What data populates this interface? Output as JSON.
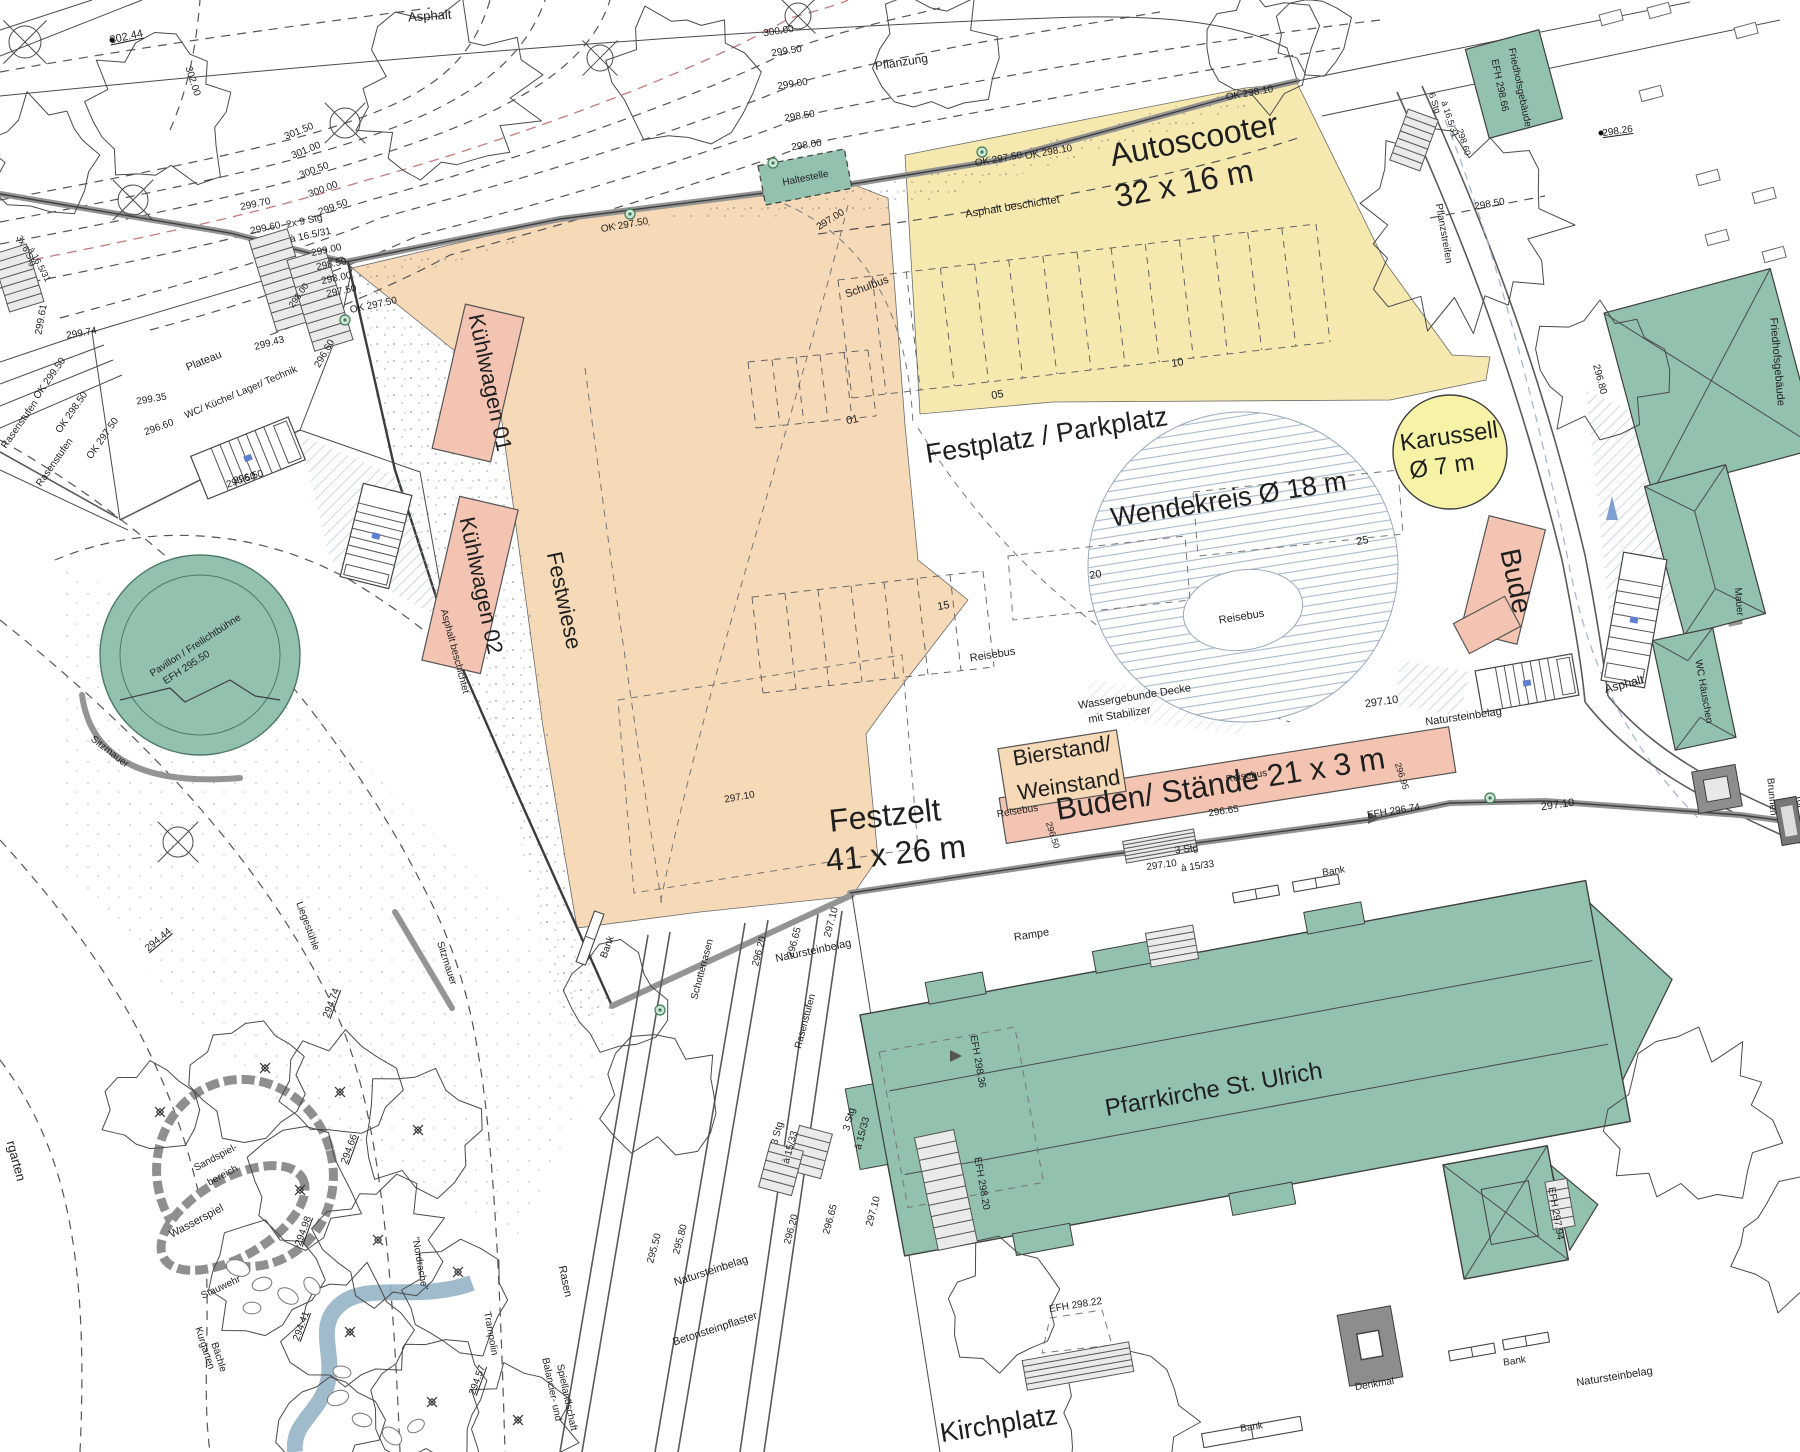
{
  "plan": {
    "colors": {
      "text": "#1f1f1f",
      "red": "#b85c5c",
      "orange": "#f6d9b6",
      "yellow": "#f6e9b0",
      "pink": "#f4c4b2",
      "green": "#92c1ad",
      "green_edge": "#3d6a58",
      "pale_yellow": "#f6f3a6",
      "water_blue": "#8fafc2",
      "hatch_blue": "#a9bdd8",
      "wall_gray": "#949494",
      "monument_gray": "#8d8d8d",
      "line_dark": "#3c3c3c"
    },
    "labels": [
      {
        "t": "302.44",
        "x": 127,
        "y": 40,
        "r": -12,
        "u": 1
      },
      {
        "t": "Asphalt",
        "x": 430,
        "y": 20,
        "r": -4,
        "s": 13
      },
      {
        "t": "302.00",
        "x": 190,
        "y": 82,
        "r": 72,
        "s": 10
      },
      {
        "t": "301.50",
        "x": 300,
        "y": 134,
        "r": -22,
        "s": 10
      },
      {
        "t": "301.00",
        "x": 307,
        "y": 153,
        "r": -22,
        "s": 10
      },
      {
        "t": "300.50",
        "x": 315,
        "y": 173,
        "r": -20,
        "s": 10
      },
      {
        "t": "300.00",
        "x": 324,
        "y": 192,
        "r": -20,
        "s": 10,
        "c": "red"
      },
      {
        "t": "299.50",
        "x": 334,
        "y": 210,
        "r": -20,
        "s": 10
      },
      {
        "t": "299.70",
        "x": 256,
        "y": 207,
        "r": -12,
        "s": 10
      },
      {
        "t": "299.60",
        "x": 266,
        "y": 231,
        "r": -12,
        "s": 10
      },
      {
        "t": "2x 9 Stg",
        "x": 305,
        "y": 224,
        "r": -12,
        "s": 10
      },
      {
        "t": "à 16.5/31",
        "x": 311,
        "y": 238,
        "r": -12,
        "s": 10
      },
      {
        "t": "299.00",
        "x": 327,
        "y": 253,
        "r": -12,
        "s": 10
      },
      {
        "t": "298.50",
        "x": 332,
        "y": 267,
        "r": -12,
        "s": 10
      },
      {
        "t": "298.00",
        "x": 337,
        "y": 281,
        "r": -12,
        "s": 10
      },
      {
        "t": "297.50",
        "x": 342,
        "y": 294,
        "r": -12,
        "s": 10
      },
      {
        "t": "OK 297.50",
        "x": 374,
        "y": 308,
        "r": -12,
        "s": 10
      },
      {
        "t": "OK 297.50",
        "x": 625,
        "y": 228,
        "r": -10,
        "s": 10
      },
      {
        "t": "297.00",
        "x": 832,
        "y": 222,
        "r": -32,
        "s": 10
      },
      {
        "t": "300.00",
        "x": 779,
        "y": 34,
        "r": -9,
        "s": 10,
        "c": "red"
      },
      {
        "t": "299.50",
        "x": 787,
        "y": 54,
        "r": -9,
        "s": 10
      },
      {
        "t": "299.00",
        "x": 793,
        "y": 87,
        "r": -9,
        "s": 10
      },
      {
        "t": "298.50",
        "x": 800,
        "y": 119,
        "r": -9,
        "s": 10
      },
      {
        "t": "298.00",
        "x": 807,
        "y": 148,
        "r": -9,
        "s": 10
      },
      {
        "t": "Pflanzung",
        "x": 902,
        "y": 66,
        "r": -9,
        "s": 12
      },
      {
        "t": "Haltestelle",
        "x": 806,
        "y": 181,
        "r": -11,
        "s": 10
      },
      {
        "t": "OK 297.50",
        "x": 999,
        "y": 162,
        "r": -10,
        "s": 10
      },
      {
        "t": "OK 298.10",
        "x": 1049,
        "y": 155,
        "r": -10,
        "s": 10
      },
      {
        "t": "OK 298.10",
        "x": 1250,
        "y": 96,
        "r": -10,
        "s": 10
      },
      {
        "t": "Asphalt beschichtet",
        "x": 1013,
        "y": 210,
        "r": -9,
        "s": 11
      },
      {
        "t": "Schulbus",
        "x": 868,
        "y": 290,
        "r": -20,
        "s": 11
      },
      {
        "t": "Autoscooter",
        "x": 1196,
        "y": 150,
        "r": -11,
        "s": 32
      },
      {
        "t": "32 x 16 m",
        "x": 1186,
        "y": 194,
        "r": -11,
        "s": 32
      },
      {
        "t": "6 Stg",
        "x": 1432,
        "y": 104,
        "r": 72,
        "s": 9
      },
      {
        "t": "à 16.5/31",
        "x": 1447,
        "y": 120,
        "r": 72,
        "s": 9
      },
      {
        "t": "298.60",
        "x": 1461,
        "y": 143,
        "r": 72,
        "s": 9
      },
      {
        "t": "EFH 298.66",
        "x": 1497,
        "y": 86,
        "r": 78,
        "s": 10
      },
      {
        "t": "Friedhofsgebäude",
        "x": 1517,
        "y": 88,
        "r": 78,
        "s": 10
      },
      {
        "t": "298.26",
        "x": 1618,
        "y": 134,
        "r": -8,
        "s": 10,
        "u": 1
      },
      {
        "t": "298.50",
        "x": 1490,
        "y": 207,
        "r": -10,
        "s": 10
      },
      {
        "t": "Pflanzstreifen",
        "x": 1441,
        "y": 234,
        "r": 80,
        "s": 10
      },
      {
        "t": "Friedhofsgebäude",
        "x": 1774,
        "y": 362,
        "r": 85,
        "s": 11
      },
      {
        "t": "296.80",
        "x": 1597,
        "y": 380,
        "r": 75,
        "s": 10
      },
      {
        "t": "Karussell",
        "x": 1450,
        "y": 444,
        "r": -8,
        "s": 24
      },
      {
        "t": "Ø 7 m",
        "x": 1443,
        "y": 474,
        "r": -8,
        "s": 24
      },
      {
        "t": "Festplatz / Parkplatz",
        "x": 1048,
        "y": 444,
        "r": -9,
        "s": 27
      },
      {
        "t": "Wendekreis Ø 18 m",
        "x": 1230,
        "y": 508,
        "r": -9,
        "s": 27
      },
      {
        "t": "Reisebus",
        "x": 1242,
        "y": 620,
        "r": -9,
        "s": 11
      },
      {
        "t": "Reisebus",
        "x": 993,
        "y": 658,
        "r": -9,
        "s": 11
      },
      {
        "t": "Reisebus",
        "x": 1018,
        "y": 814,
        "r": -9,
        "s": 10
      },
      {
        "t": "Reisebus",
        "x": 1247,
        "y": 779,
        "r": -9,
        "s": 10
      },
      {
        "t": "01",
        "x": 853,
        "y": 423,
        "r": -12,
        "s": 11
      },
      {
        "t": "05",
        "x": 998,
        "y": 398,
        "r": -10,
        "s": 11
      },
      {
        "t": "10",
        "x": 1178,
        "y": 366,
        "r": -10,
        "s": 11
      },
      {
        "t": "15",
        "x": 944,
        "y": 609,
        "r": -10,
        "s": 11
      },
      {
        "t": "20",
        "x": 1096,
        "y": 578,
        "r": -10,
        "s": 11
      },
      {
        "t": "25",
        "x": 1363,
        "y": 544,
        "r": -10,
        "s": 11
      },
      {
        "t": "Wassergebunde Decke",
        "x": 1135,
        "y": 700,
        "r": -9,
        "s": 11
      },
      {
        "t": "mit Stabilizer",
        "x": 1120,
        "y": 718,
        "r": -9,
        "s": 11
      },
      {
        "t": "Bude",
        "x": 1507,
        "y": 583,
        "r": 78,
        "s": 28
      },
      {
        "t": "Bierstand/",
        "x": 1063,
        "y": 758,
        "r": -9,
        "s": 22
      },
      {
        "t": "Weinstand",
        "x": 1070,
        "y": 792,
        "r": -9,
        "s": 22
      },
      {
        "t": "Buden/ Stände 21 x 3 m",
        "x": 1222,
        "y": 794,
        "r": -9,
        "s": 31
      },
      {
        "t": "296.65",
        "x": 1224,
        "y": 814,
        "r": -9,
        "s": 10
      },
      {
        "t": "296.95",
        "x": 1399,
        "y": 777,
        "r": 72,
        "s": 9
      },
      {
        "t": "Festwiese",
        "x": 557,
        "y": 602,
        "r": 78,
        "s": 22
      },
      {
        "t": "Kühlwagen 01",
        "x": 483,
        "y": 384,
        "r": 78,
        "s": 22
      },
      {
        "t": "Kühlwagen 02",
        "x": 474,
        "y": 587,
        "r": 78,
        "s": 22
      },
      {
        "t": "Festzelt",
        "x": 886,
        "y": 826,
        "r": -6,
        "s": 32
      },
      {
        "t": "41 x 26 m",
        "x": 897,
        "y": 864,
        "r": -6,
        "s": 32
      },
      {
        "t": "296.50",
        "x": 1050,
        "y": 836,
        "r": 72,
        "s": 9
      },
      {
        "t": "Mauer",
        "x": 1736,
        "y": 602,
        "r": 85,
        "s": 10
      },
      {
        "t": "WC Häuschen",
        "x": 1701,
        "y": 692,
        "r": 80,
        "s": 10
      },
      {
        "t": "Asphalt",
        "x": 1625,
        "y": 688,
        "r": -15,
        "s": 12
      },
      {
        "t": "Brunnen",
        "x": 1769,
        "y": 797,
        "r": 85,
        "s": 10
      },
      {
        "t": "Tor",
        "x": 1797,
        "y": 802,
        "r": 80,
        "s": 10
      },
      {
        "t": "297.10",
        "x": 1558,
        "y": 808,
        "r": -8,
        "s": 11
      },
      {
        "t": "297.10",
        "x": 1382,
        "y": 705,
        "r": -8,
        "s": 11
      },
      {
        "t": "Natursteinbelag",
        "x": 1464,
        "y": 720,
        "r": -8,
        "s": 11
      },
      {
        "t": "297.10",
        "x": 1162,
        "y": 868,
        "r": -8,
        "s": 10
      },
      {
        "t": "3 Stg",
        "x": 1187,
        "y": 852,
        "r": -8,
        "s": 10
      },
      {
        "t": "à 15/33",
        "x": 1198,
        "y": 869,
        "r": -8,
        "s": 10
      },
      {
        "t": "Bank",
        "x": 1334,
        "y": 874,
        "r": -9,
        "s": 10
      },
      {
        "t": "Rampe",
        "x": 1032,
        "y": 938,
        "r": -9,
        "s": 11
      },
      {
        "t": "Natursteinbelag",
        "x": 814,
        "y": 954,
        "r": -12,
        "s": 11
      },
      {
        "t": "297.10",
        "x": 740,
        "y": 800,
        "r": -10,
        "s": 10
      },
      {
        "t": "297.10",
        "x": 834,
        "y": 923,
        "r": -75,
        "s": 10
      },
      {
        "t": "296.65",
        "x": 797,
        "y": 943,
        "r": -75,
        "s": 10
      },
      {
        "t": "296.20",
        "x": 762,
        "y": 952,
        "r": -75,
        "s": 10
      },
      {
        "t": "Rasenstufen",
        "x": 808,
        "y": 1022,
        "r": -75,
        "s": 10
      },
      {
        "t": "Schotterrasen",
        "x": 705,
        "y": 970,
        "r": -75,
        "s": 10
      },
      {
        "t": "Bank",
        "x": 610,
        "y": 948,
        "r": -70,
        "s": 10
      },
      {
        "t": "3 Stg",
        "x": 780,
        "y": 1134,
        "r": -75,
        "s": 10
      },
      {
        "t": "à 15/33",
        "x": 793,
        "y": 1148,
        "r": -75,
        "s": 10
      },
      {
        "t": "3 Stg",
        "x": 852,
        "y": 1120,
        "r": -75,
        "s": 10
      },
      {
        "t": "à 15/33",
        "x": 865,
        "y": 1134,
        "r": -75,
        "s": 10
      },
      {
        "t": "297.10",
        "x": 876,
        "y": 1212,
        "r": -75,
        "s": 10
      },
      {
        "t": "296.65",
        "x": 833,
        "y": 1220,
        "r": -75,
        "s": 10
      },
      {
        "t": "296.20",
        "x": 794,
        "y": 1230,
        "r": -75,
        "s": 10
      },
      {
        "t": "295.80",
        "x": 683,
        "y": 1240,
        "r": -75,
        "s": 10
      },
      {
        "t": "295.50",
        "x": 657,
        "y": 1249,
        "r": -75,
        "s": 10
      },
      {
        "t": "Natursteinbelag",
        "x": 712,
        "y": 1274,
        "r": -18,
        "s": 11
      },
      {
        "t": "Betonsteinpflaster",
        "x": 716,
        "y": 1332,
        "r": -18,
        "s": 11
      },
      {
        "t": "Rasen",
        "x": 562,
        "y": 1282,
        "r": 78,
        "s": 11
      },
      {
        "t": "Balancier- und",
        "x": 549,
        "y": 1390,
        "r": 78,
        "s": 10
      },
      {
        "t": "Spiellandschaft",
        "x": 564,
        "y": 1398,
        "r": 78,
        "s": 10
      },
      {
        "t": "Trampolin",
        "x": 488,
        "y": 1334,
        "r": 80,
        "s": 10
      },
      {
        "t": "\"Nordrache\"",
        "x": 417,
        "y": 1264,
        "r": 80,
        "s": 10
      },
      {
        "t": "294.66",
        "x": 352,
        "y": 1150,
        "r": -70,
        "s": 10,
        "u": 1
      },
      {
        "t": "294.98",
        "x": 306,
        "y": 1232,
        "r": -70,
        "s": 10,
        "u": 1
      },
      {
        "t": "294.41",
        "x": 304,
        "y": 1327,
        "r": -70,
        "s": 10,
        "u": 1
      },
      {
        "t": "294.57",
        "x": 480,
        "y": 1381,
        "r": -70,
        "s": 10,
        "u": 1
      },
      {
        "t": "294.74",
        "x": 334,
        "y": 1004,
        "r": -70,
        "s": 10,
        "u": 1
      },
      {
        "t": "294.44",
        "x": 160,
        "y": 942,
        "r": -40,
        "s": 10,
        "u": 1
      },
      {
        "t": "Liegestühle",
        "x": 305,
        "y": 927,
        "r": 70,
        "s": 10
      },
      {
        "t": "Sitzmauer",
        "x": 108,
        "y": 754,
        "r": 38,
        "s": 10
      },
      {
        "t": "Sitzmauer",
        "x": 444,
        "y": 964,
        "r": 72,
        "s": 10
      },
      {
        "t": "Stauwehr",
        "x": 222,
        "y": 1290,
        "r": -25,
        "s": 10
      },
      {
        "t": "Kurgarten",
        "x": 202,
        "y": 1349,
        "r": 72,
        "s": 10
      },
      {
        "t": "Bächle",
        "x": 216,
        "y": 1358,
        "r": 72,
        "s": 10
      },
      {
        "t": "Wasserspiel",
        "x": 198,
        "y": 1224,
        "r": -28,
        "s": 11
      },
      {
        "t": "Sandspiel-",
        "x": 217,
        "y": 1160,
        "r": -28,
        "s": 10
      },
      {
        "t": "bereich",
        "x": 224,
        "y": 1178,
        "r": -28,
        "s": 10
      },
      {
        "t": "rgarten",
        "x": 12,
        "y": 1162,
        "r": 75,
        "s": 13
      },
      {
        "t": "Pavillon / Freilichtbühne",
        "x": 197,
        "y": 648,
        "r": -33,
        "s": 10
      },
      {
        "t": "EFH 295.50",
        "x": 188,
        "y": 670,
        "r": -33,
        "s": 10
      },
      {
        "t": "296.50",
        "x": 242,
        "y": 483,
        "r": -18,
        "s": 10
      },
      {
        "t": "Pfarrkirche St. Ulrich",
        "x": 1215,
        "y": 1097,
        "r": -10,
        "s": 24
      },
      {
        "t": "EFH 298.36",
        "x": 975,
        "y": 1062,
        "r": 80,
        "s": 10
      },
      {
        "t": "EFH 298.20",
        "x": 979,
        "y": 1184,
        "r": 80,
        "s": 10
      },
      {
        "t": "EFH 298.22",
        "x": 1076,
        "y": 1308,
        "r": -9,
        "s": 10
      },
      {
        "t": "EFH 297.94",
        "x": 1553,
        "y": 1214,
        "r": 80,
        "s": 10
      },
      {
        "t": "EFH 296.74",
        "x": 1394,
        "y": 814,
        "r": -9,
        "s": 10
      },
      {
        "t": "Denkmal",
        "x": 1375,
        "y": 1387,
        "r": -9,
        "s": 10
      },
      {
        "t": "Bank",
        "x": 1515,
        "y": 1364,
        "r": -9,
        "s": 10
      },
      {
        "t": "Bank",
        "x": 1252,
        "y": 1430,
        "r": -9,
        "s": 10
      },
      {
        "t": "Natursteinbelag",
        "x": 1615,
        "y": 1380,
        "r": -9,
        "s": 11
      },
      {
        "t": "Kirchplatz",
        "x": 1000,
        "y": 1433,
        "r": -9,
        "s": 27
      },
      {
        "t": "Plateau",
        "x": 205,
        "y": 364,
        "r": -22,
        "s": 11
      },
      {
        "t": "WC/ Küche/ Lager/ Technik",
        "x": 242,
        "y": 395,
        "r": -23,
        "s": 10
      },
      {
        "t": "299.61",
        "x": 44,
        "y": 320,
        "r": -80,
        "s": 10
      },
      {
        "t": "299.74",
        "x": 82,
        "y": 336,
        "r": -10,
        "s": 10
      },
      {
        "t": "299.43",
        "x": 270,
        "y": 346,
        "r": -15,
        "s": 10
      },
      {
        "t": "296.60",
        "x": 327,
        "y": 355,
        "r": -60,
        "s": 10
      },
      {
        "t": "299.35",
        "x": 152,
        "y": 402,
        "r": -10,
        "s": 10
      },
      {
        "t": "OK 299.50",
        "x": 52,
        "y": 380,
        "r": -55,
        "s": 10
      },
      {
        "t": "OK 298.50",
        "x": 74,
        "y": 414,
        "r": -55,
        "s": 10
      },
      {
        "t": "OK 297.50",
        "x": 105,
        "y": 440,
        "r": -55,
        "s": 10
      },
      {
        "t": "Rasenstufen",
        "x": 22,
        "y": 426,
        "r": -55,
        "s": 10
      },
      {
        "t": "Rasenstufen",
        "x": 57,
        "y": 464,
        "r": -55,
        "s": 10
      },
      {
        "t": "296.60",
        "x": 160,
        "y": 430,
        "r": -20,
        "s": 10
      },
      {
        "t": "296.50",
        "x": 249,
        "y": 480,
        "r": -15,
        "s": 10
      },
      {
        "t": "3x 6 Stg",
        "x": 24,
        "y": 252,
        "r": 62,
        "s": 9
      },
      {
        "t": "à 16.5/31",
        "x": 37,
        "y": 266,
        "r": 62,
        "s": 9
      },
      {
        "t": "298.00",
        "x": 301,
        "y": 297,
        "r": -55,
        "s": 9
      },
      {
        "t": "Asphalt beschichtet",
        "x": 452,
        "y": 652,
        "r": 75,
        "s": 10
      }
    ]
  }
}
